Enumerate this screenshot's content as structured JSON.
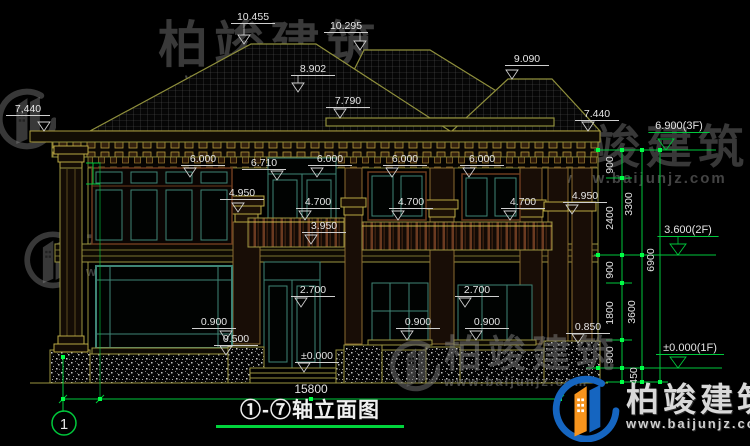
{
  "drawing": {
    "title": "①-⑦轴立面图",
    "axis_label": "1",
    "total_width": "15800"
  },
  "watermark": {
    "brand": "柏竣建筑",
    "url": "www.baijunjz.com"
  },
  "colors": {
    "line_yellow": "#9a9440",
    "line_olive": "#8f8f3c",
    "dim_green": "#00c83c",
    "grip_green": "#00ff46",
    "text_white": "#e4e4e4",
    "marker_line": "#cfcfcf",
    "frame_teal": "#3f8575",
    "wood_brown": "#6b3a1e",
    "underline_green": "#00d43c"
  },
  "elevation_markers": [
    {
      "t": "10.455",
      "x": 253,
      "y": 20,
      "a": 244,
      "b": 44
    },
    {
      "t": "10.295",
      "x": 346,
      "y": 29,
      "a": 360,
      "b": 50
    },
    {
      "t": "8.902",
      "x": 313,
      "y": 72,
      "a": 298,
      "b": 92
    },
    {
      "t": "7.790",
      "x": 348,
      "y": 104,
      "a": 340,
      "b": 118
    },
    {
      "t": "9.090",
      "x": 527,
      "y": 62,
      "a": 512,
      "b": 79
    },
    {
      "t": "7,440",
      "x": 28,
      "y": 112,
      "a": 44,
      "b": 131
    },
    {
      "t": "7.440",
      "x": 597,
      "y": 117,
      "a": 588,
      "b": 131
    },
    {
      "t": "6.000",
      "x": 203,
      "y": 162,
      "a": 190,
      "b": 177
    },
    {
      "t": "6.710",
      "x": 264,
      "y": 166,
      "a": 277,
      "b": 180
    },
    {
      "t": "6.000",
      "x": 330,
      "y": 162,
      "a": 317,
      "b": 177
    },
    {
      "t": "6.000",
      "x": 405,
      "y": 162,
      "a": 392,
      "b": 177
    },
    {
      "t": "6.000",
      "x": 482,
      "y": 162,
      "a": 469,
      "b": 177
    },
    {
      "t": "4.950",
      "x": 242,
      "y": 196,
      "a": 238,
      "b": 212
    },
    {
      "t": "4.950",
      "x": 585,
      "y": 199,
      "a": 572,
      "b": 214
    },
    {
      "t": "4.700",
      "x": 318,
      "y": 205,
      "a": 305,
      "b": 220
    },
    {
      "t": "4.700",
      "x": 411,
      "y": 205,
      "a": 398,
      "b": 220
    },
    {
      "t": "4.700",
      "x": 523,
      "y": 205,
      "a": 510,
      "b": 220
    },
    {
      "t": "3.950",
      "x": 324,
      "y": 229,
      "a": 311,
      "b": 244
    },
    {
      "t": "2.700",
      "x": 313,
      "y": 293,
      "a": 301,
      "b": 307
    },
    {
      "t": "2.700",
      "x": 477,
      "y": 293,
      "a": 465,
      "b": 307
    },
    {
      "t": "0.900",
      "x": 214,
      "y": 325,
      "a": 226,
      "b": 340
    },
    {
      "t": "0.900",
      "x": 418,
      "y": 325,
      "a": 407,
      "b": 340
    },
    {
      "t": "0.900",
      "x": 487,
      "y": 325,
      "a": 476,
      "b": 340
    },
    {
      "t": "0.500",
      "x": 236,
      "y": 342,
      "a": 226,
      "b": 355
    },
    {
      "t": "0.850",
      "x": 588,
      "y": 330,
      "a": 578,
      "b": 343
    },
    {
      "t": "±0.000",
      "x": 317,
      "y": 359,
      "a": 304,
      "b": 372
    },
    {
      "t": "6.900(3F)",
      "x": 679,
      "y": 129,
      "a": 666,
      "b": 150,
      "g": 1
    },
    {
      "t": "3.600(2F)",
      "x": 688,
      "y": 233,
      "a": 678,
      "b": 255,
      "g": 1
    },
    {
      "t": "±0.000(1F)",
      "x": 690,
      "y": 351,
      "a": 678,
      "b": 368,
      "g": 1
    }
  ],
  "rotated_dims": [
    {
      "t": "900",
      "x": 613,
      "y": 165
    },
    {
      "t": "2400",
      "x": 613,
      "y": 218
    },
    {
      "t": "3300",
      "x": 632,
      "y": 204
    },
    {
      "t": "900",
      "x": 613,
      "y": 270
    },
    {
      "t": "1800",
      "x": 613,
      "y": 313
    },
    {
      "t": "3600",
      "x": 635,
      "y": 312
    },
    {
      "t": "900",
      "x": 613,
      "y": 355
    },
    {
      "t": "450",
      "x": 637,
      "y": 376
    },
    {
      "t": "6900",
      "x": 654,
      "y": 260
    }
  ],
  "plain_labels": [
    {
      "t": "15800",
      "x": 311,
      "y": 393,
      "s": 12
    },
    {
      "t": "1",
      "x": 64,
      "y": 429,
      "s": 15
    }
  ]
}
